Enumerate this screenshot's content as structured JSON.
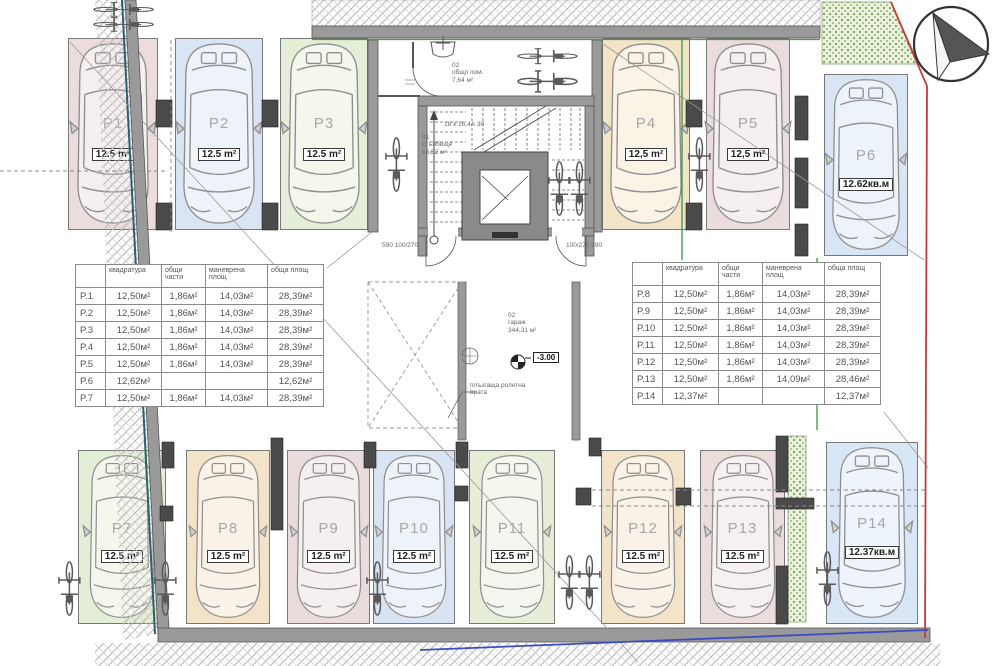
{
  "drawing": {
    "type": "underground-garage-floor-plan"
  },
  "rooms": {
    "common_room": {
      "number": "02",
      "name": "общо пом.",
      "area": "7,64 м²"
    },
    "staircase": {
      "number": "01",
      "name": "стълбище",
      "area": "16,52 м²"
    },
    "garage": {
      "number": "02",
      "name": "гараж",
      "area": "344,31 м²"
    }
  },
  "annotations": {
    "level_marker": "-3.00",
    "stair_steps_note": "18 х 16,4А 30",
    "door_label_1": "плъзгаща ролетна",
    "door_label_2": "врата",
    "door_dim_left": "590 100/270",
    "door_dim_right": "100/270 590"
  },
  "compass": {
    "icon": "north-arrow"
  },
  "colors": {
    "boundary_red": "#c43b3b",
    "boundary_blue": "#3b4bc4",
    "boundary_green": "#4a9a4a",
    "boundary_teal": "#2e5f6e",
    "wall_gray": "#9a9a9a",
    "wall_dark": "#4a4a4a",
    "landscaping_green": "#5d8a46"
  },
  "stalls": [
    {
      "id": "P1",
      "label": "P1",
      "area": "12.5 m²",
      "color": "#ecdcdc"
    },
    {
      "id": "P2",
      "label": "P2",
      "area": "12.5 m²",
      "color": "#d9e5f3"
    },
    {
      "id": "P3",
      "label": "P3",
      "area": "12.5 m²",
      "color": "#e5eed6"
    },
    {
      "id": "P4",
      "label": "P4",
      "area": "12,5 m²",
      "color": "#f4e4c7"
    },
    {
      "id": "P5",
      "label": "P5",
      "area": "12,5 m²",
      "color": "#eadcdc"
    },
    {
      "id": "P6",
      "label": "P6",
      "area": "12.62кв.м",
      "color": "#d7e5f4"
    },
    {
      "id": "P7",
      "label": "P7",
      "area": "12.5 m²",
      "color": "#e4eed6"
    },
    {
      "id": "P8",
      "label": "P8",
      "area": "12.5 m²",
      "color": "#f3e3c8"
    },
    {
      "id": "P9",
      "label": "P9",
      "area": "12.5 m²",
      "color": "#eadcdc"
    },
    {
      "id": "P10",
      "label": "P10",
      "area": "12.5 m²",
      "color": "#d8e4f2"
    },
    {
      "id": "P11",
      "label": "P11",
      "area": "12.5 m²",
      "color": "#e6eed8"
    },
    {
      "id": "P12",
      "label": "P12",
      "area": "12.5 m²",
      "color": "#f3e3c8"
    },
    {
      "id": "P13",
      "label": "P13",
      "area": "12.5 m²",
      "color": "#ecdddd"
    },
    {
      "id": "P14",
      "label": "P14",
      "area": "12.37кв.м",
      "color": "#d8e6f5"
    }
  ],
  "tables": {
    "left": {
      "headers": [
        "",
        "квадратура",
        "общи части",
        "маневрена площ",
        "обща площ"
      ],
      "rows": [
        [
          "P.1",
          "12,50м²",
          "1,86м²",
          "14,03м²",
          "28,39м²"
        ],
        [
          "P.2",
          "12,50м²",
          "1,86м²",
          "14,03м²",
          "28,39м²"
        ],
        [
          "P.3",
          "12,50м²",
          "1,86м²",
          "14,03м²",
          "28,39м²"
        ],
        [
          "P.4",
          "12,50м²",
          "1,86м²",
          "14,03м²",
          "28,39м²"
        ],
        [
          "P.5",
          "12,50м²",
          "1,86м²",
          "14,03м²",
          "28,39м²"
        ],
        [
          "P.6",
          "12,62м²",
          "",
          "",
          "12,62м²"
        ],
        [
          "P.7",
          "12,50м²",
          "1,86м²",
          "14,03м²",
          "28,39м²"
        ]
      ]
    },
    "right": {
      "headers": [
        "",
        "квадратура",
        "общи части",
        "маневрена площ",
        "обща площ"
      ],
      "rows": [
        [
          "P.8",
          "12,50м²",
          "1,86м²",
          "14,03м²",
          "28,39м²"
        ],
        [
          "P.9",
          "12,50м²",
          "1,86м²",
          "14,03м²",
          "28,39м²"
        ],
        [
          "P.10",
          "12,50м²",
          "1,86м²",
          "14,03м²",
          "28,39м²"
        ],
        [
          "P.11",
          "12,50м²",
          "1,86м²",
          "14,03м²",
          "28,39м²"
        ],
        [
          "P.12",
          "12,50м²",
          "1,86м²",
          "14,03м²",
          "28,39м²"
        ],
        [
          "P.13",
          "12,50м²",
          "1,86м²",
          "14,09м²",
          "28,46м²"
        ],
        [
          "P.14",
          "12,37м²",
          "",
          "",
          "12,37м²"
        ]
      ]
    }
  }
}
